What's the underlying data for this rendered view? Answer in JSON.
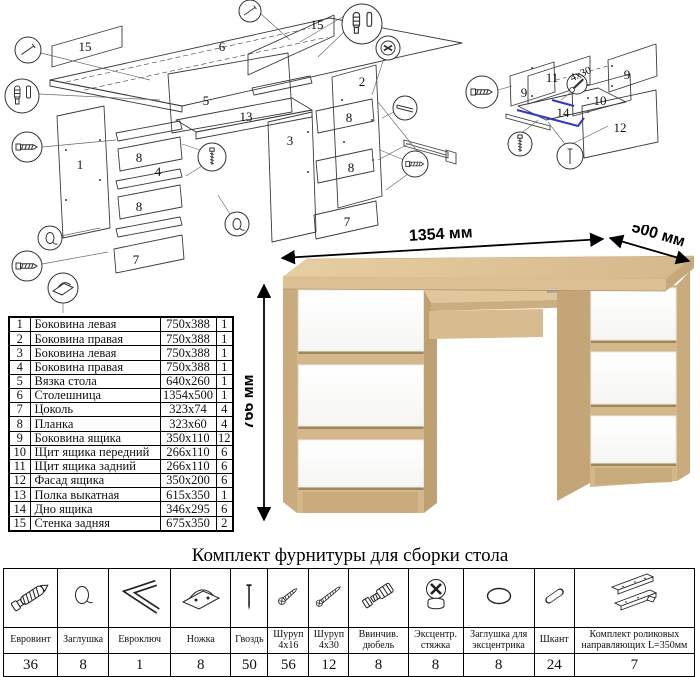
{
  "desk": {
    "dim_width": "1354 мм",
    "dim_depth": "500 мм",
    "dim_height": "766 мм"
  },
  "colors": {
    "oak": "#d6b98c",
    "oak_dark": "#c2a477",
    "drawer_white": "#ffffff",
    "highlight_blue": "#2b35d8",
    "line_art": "#3c3c3c"
  },
  "diagram_main": {
    "labels": [
      "15",
      "6",
      "15",
      "5",
      "13",
      "1",
      "8",
      "4",
      "8",
      "7",
      "2",
      "3",
      "8",
      "8",
      "7"
    ]
  },
  "diagram_drawer": {
    "labels": [
      "11",
      "9",
      "9",
      "10",
      "14",
      "12"
    ],
    "screw_note": "4x30"
  },
  "parts": {
    "rows": [
      {
        "num": "1",
        "name": "Боковина левая",
        "size": "750x388",
        "qty": "1"
      },
      {
        "num": "2",
        "name": "Боковина правая",
        "size": "750x388",
        "qty": "1"
      },
      {
        "num": "3",
        "name": "Боковина левая",
        "size": "750x388",
        "qty": "1"
      },
      {
        "num": "4",
        "name": "Боковина правая",
        "size": "750x388",
        "qty": "1"
      },
      {
        "num": "5",
        "name": "Вязка стола",
        "size": "640x260",
        "qty": "1"
      },
      {
        "num": "6",
        "name": "Столешница",
        "size": "1354x500",
        "qty": "1"
      },
      {
        "num": "7",
        "name": "Цоколь",
        "size": "323x74",
        "qty": "4"
      },
      {
        "num": "8",
        "name": "Планка",
        "size": "323x60",
        "qty": "4"
      },
      {
        "num": "9",
        "name": "Боковина ящика",
        "size": "350x110",
        "qty": "12"
      },
      {
        "num": "10",
        "name": "Щит ящика передний",
        "size": "266x110",
        "qty": "6"
      },
      {
        "num": "11",
        "name": "Щит ящика задний",
        "size": "266x110",
        "qty": "6"
      },
      {
        "num": "12",
        "name": "Фасад ящика",
        "size": "350x200",
        "qty": "6"
      },
      {
        "num": "13",
        "name": "Полка выкатная",
        "size": "615x350",
        "qty": "1"
      },
      {
        "num": "14",
        "name": "Дно ящика",
        "size": "346x295",
        "qty": "6"
      },
      {
        "num": "15",
        "name": "Стенка задняя",
        "size": "675x350",
        "qty": "2"
      }
    ]
  },
  "hardware": {
    "title": "Комплект фурнитуры для сборки стола",
    "items": [
      {
        "label": "Евровинт",
        "qty": "36",
        "icon": "euroscrew-icon"
      },
      {
        "label": "Заглушка",
        "qty": "8",
        "icon": "cap-icon"
      },
      {
        "label": "Евроключ",
        "qty": "1",
        "icon": "hexkey-icon"
      },
      {
        "label": "Ножка",
        "qty": "8",
        "icon": "foot-icon"
      },
      {
        "label": "Гвоздь",
        "qty": "50",
        "icon": "nail-icon"
      },
      {
        "label": "Шуруп 4x16",
        "qty": "56",
        "icon": "screw-4x16-icon"
      },
      {
        "label": "Шуруп 4x30",
        "qty": "12",
        "icon": "screw-4x30-icon"
      },
      {
        "label": "Ввинчив. дюбель",
        "qty": "8",
        "icon": "screw-dowel-icon"
      },
      {
        "label": "Эксцентр. стяжка",
        "qty": "8",
        "icon": "eccentric-cam-icon"
      },
      {
        "label": "Заглушка для эксцентрика",
        "qty": "8",
        "icon": "eccentric-cap-icon"
      },
      {
        "label": "Шкант",
        "qty": "24",
        "icon": "dowel-icon"
      },
      {
        "label": "Комплект роликовых направляющих L=350мм",
        "qty": "7",
        "icon": "drawer-rails-icon"
      }
    ]
  }
}
